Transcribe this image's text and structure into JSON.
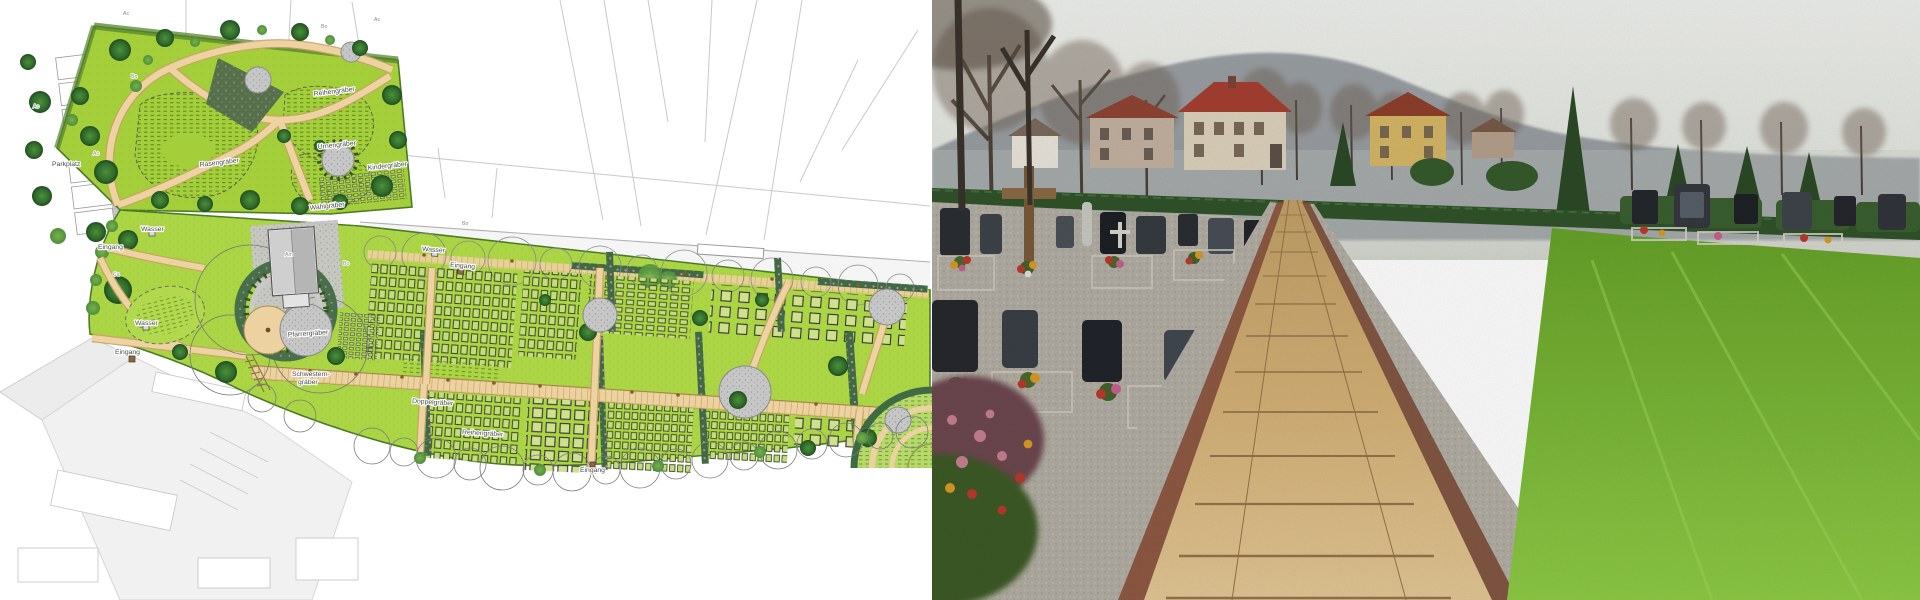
{
  "page": {
    "description_left": "cemetery landscape master plan drawing",
    "description_right": "photograph of cemetery main walkway"
  },
  "plan": {
    "labels": [
      {
        "text": "Parkplatz"
      },
      {
        "text": "Rasengräber"
      },
      {
        "text": "Reihengräber"
      },
      {
        "text": "Urnengräber"
      },
      {
        "text": "Kindergräber"
      },
      {
        "text": "Wahlgräber"
      },
      {
        "text": "Wasser"
      },
      {
        "text": "Eingang"
      },
      {
        "text": "Wasser"
      },
      {
        "text": "Eingang"
      },
      {
        "text": "Wasser"
      },
      {
        "text": "Eingang"
      },
      {
        "text": "Pfarrergräber"
      },
      {
        "text": "Schwestern-"
      },
      {
        "text": "gräber"
      },
      {
        "text": "Doppelgräber"
      },
      {
        "text": "Reihengräber"
      },
      {
        "text": "Eingang"
      }
    ],
    "tree_codes": [
      {
        "text": "Ac"
      },
      {
        "text": "Bo"
      },
      {
        "text": "Ac"
      },
      {
        "text": "Bo"
      },
      {
        "text": "Ac"
      },
      {
        "text": "Ca"
      },
      {
        "text": "Am"
      },
      {
        "text": "Bo"
      },
      {
        "text": "Bo"
      },
      {
        "text": "Ac"
      }
    ],
    "colors": {
      "grass": "#abd544",
      "wood_tree": "#2f6b2c",
      "path_tan": "#ecd2a0",
      "hedge": "#3f6b44",
      "hedge_flowers": "#d77fae",
      "plaza_gray": "#c6c6c6"
    }
  },
  "photo": {
    "colors": {
      "sky": "#e9ebe6",
      "hill": "#878d93",
      "lawn": "#7cc238",
      "path": "#d2ae74",
      "gravel": "#b3aea4",
      "hedge": "#31532a",
      "roof_red": "#a64031",
      "house_yellow": "#d6b766"
    }
  }
}
